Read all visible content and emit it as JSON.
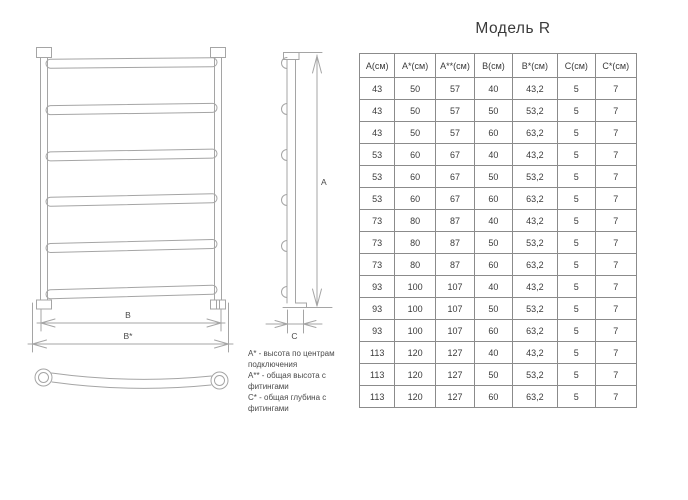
{
  "page": {
    "title": "Модель R"
  },
  "table": {
    "headers": [
      "А(см)",
      "А*(см)",
      "А**(см)",
      "В(см)",
      "В*(см)",
      "С(см)",
      "С*(см)"
    ],
    "rows": [
      [
        "43",
        "50",
        "57",
        "40",
        "43,2",
        "5",
        "7"
      ],
      [
        "43",
        "50",
        "57",
        "50",
        "53,2",
        "5",
        "7"
      ],
      [
        "43",
        "50",
        "57",
        "60",
        "63,2",
        "5",
        "7"
      ],
      [
        "53",
        "60",
        "67",
        "40",
        "43,2",
        "5",
        "7"
      ],
      [
        "53",
        "60",
        "67",
        "50",
        "53,2",
        "5",
        "7"
      ],
      [
        "53",
        "60",
        "67",
        "60",
        "63,2",
        "5",
        "7"
      ],
      [
        "73",
        "80",
        "87",
        "40",
        "43,2",
        "5",
        "7"
      ],
      [
        "73",
        "80",
        "87",
        "50",
        "53,2",
        "5",
        "7"
      ],
      [
        "73",
        "80",
        "87",
        "60",
        "63,2",
        "5",
        "7"
      ],
      [
        "93",
        "100",
        "107",
        "40",
        "43,2",
        "5",
        "7"
      ],
      [
        "93",
        "100",
        "107",
        "50",
        "53,2",
        "5",
        "7"
      ],
      [
        "93",
        "100",
        "107",
        "60",
        "63,2",
        "5",
        "7"
      ],
      [
        "113",
        "120",
        "127",
        "40",
        "43,2",
        "5",
        "7"
      ],
      [
        "113",
        "120",
        "127",
        "50",
        "53,2",
        "5",
        "7"
      ],
      [
        "113",
        "120",
        "127",
        "60",
        "63,2",
        "5",
        "7"
      ]
    ]
  },
  "dimensions": {
    "a": "А",
    "b": "В",
    "b_star": "В*",
    "c": "С"
  },
  "legend": {
    "items": [
      "А* - высота по центрам подключения",
      "А** - общая высота с фитингами",
      "С* - общая глубина с фитингами"
    ]
  },
  "colors": {
    "drawing_line": "#a5a5a5",
    "table_border": "#8b8b8b",
    "text": "#3d3d3d",
    "background": "#ffffff"
  }
}
